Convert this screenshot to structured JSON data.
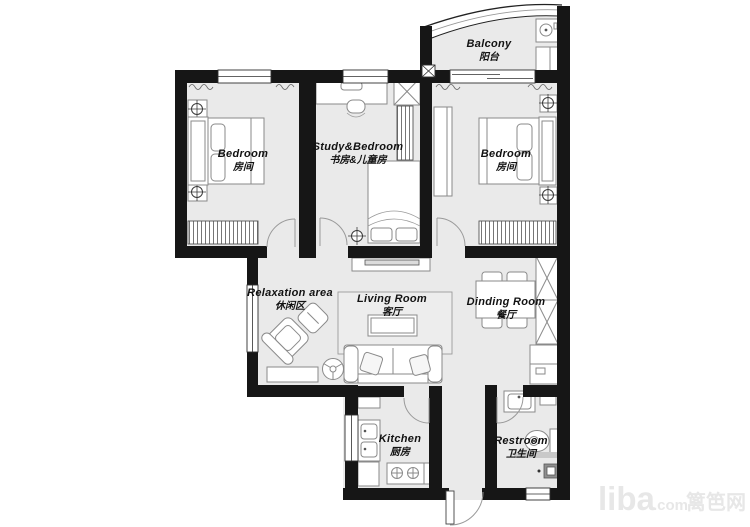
{
  "watermark": {
    "site": "liba",
    "tld": ".com",
    "cn": "篱笆网"
  },
  "rooms": {
    "bedroom_left": {
      "en": "Bedroom",
      "zh": "房间"
    },
    "study_bedroom": {
      "en": "Study&Bedroom",
      "zh": "书房&儿童房"
    },
    "balcony": {
      "en": "Balcony",
      "zh": "阳台"
    },
    "bedroom_right": {
      "en": "Bedroom",
      "zh": "房间"
    },
    "relaxation": {
      "en": "Relaxation area",
      "zh": "休闲区"
    },
    "living_room": {
      "en": "Living Room",
      "zh": "客厅"
    },
    "dining_room": {
      "en": "Dinding Room",
      "zh": "餐厅"
    },
    "kitchen": {
      "en": "Kitchen",
      "zh": "厨房"
    },
    "restroom": {
      "en": "Restroom",
      "zh": "卫生间"
    }
  },
  "colors": {
    "wall": "#161616",
    "floor": "#eaeaea",
    "furniture_stroke": "#8a8a8a",
    "label": "#121212",
    "watermark": "#e7e7e7"
  }
}
